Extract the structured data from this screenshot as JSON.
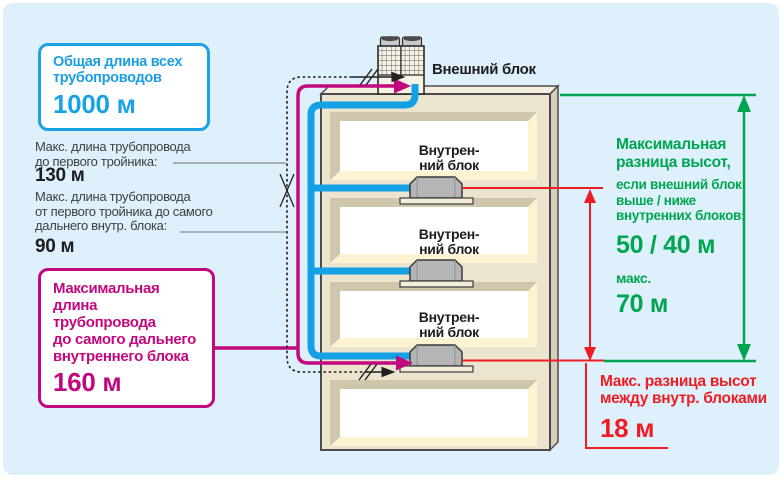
{
  "panel": {
    "background": "#def0fb"
  },
  "colors": {
    "pipe_blue": "#14a0e4",
    "pipe_magenta": "#c2087e",
    "measure_green": "#00a551",
    "measure_red": "#ee1c23",
    "building_outline": "#4b4b4d",
    "building_fill": "#ebe4cf"
  },
  "total_pipe_box": {
    "title_lines": [
      "Общая длина всех",
      "трубопроводов"
    ],
    "value": "1000 м"
  },
  "first_tee_note": {
    "lines": [
      "Макс. длина трубопровода",
      "до первого тройника:"
    ],
    "value": "130 м"
  },
  "tee_to_farthest_note": {
    "lines": [
      "Макс. длина трубопровода",
      "от первого тройника до самого",
      "дальнего внутр. блока:"
    ],
    "value": "90 м"
  },
  "max_pipe_box": {
    "title_lines": [
      "Максимальная",
      "длина трубопровода",
      "до самого дальнего",
      "внутреннего блока"
    ],
    "value": "160 м"
  },
  "outdoor_unit_label": "Внешний блок",
  "indoor_units": [
    {
      "label_lines": [
        "Внутрен-",
        "ний блок"
      ]
    },
    {
      "label_lines": [
        "Внутрен-",
        "ний блок"
      ]
    },
    {
      "label_lines": [
        "Внутрен-",
        "ний блок"
      ]
    }
  ],
  "outdoor_height_diff": {
    "title_lines": [
      "Максимальная",
      "разница высот,"
    ],
    "condition_lines": [
      "если внешний блок",
      "выше / ниже",
      "внутренних блоков:"
    ],
    "value": "50 / 40 м",
    "max_label": "макс.",
    "max_value": "70 м"
  },
  "indoor_height_diff": {
    "lines": [
      "Макс. разница высот",
      "между внутр. блоками"
    ],
    "value": "18 м"
  }
}
